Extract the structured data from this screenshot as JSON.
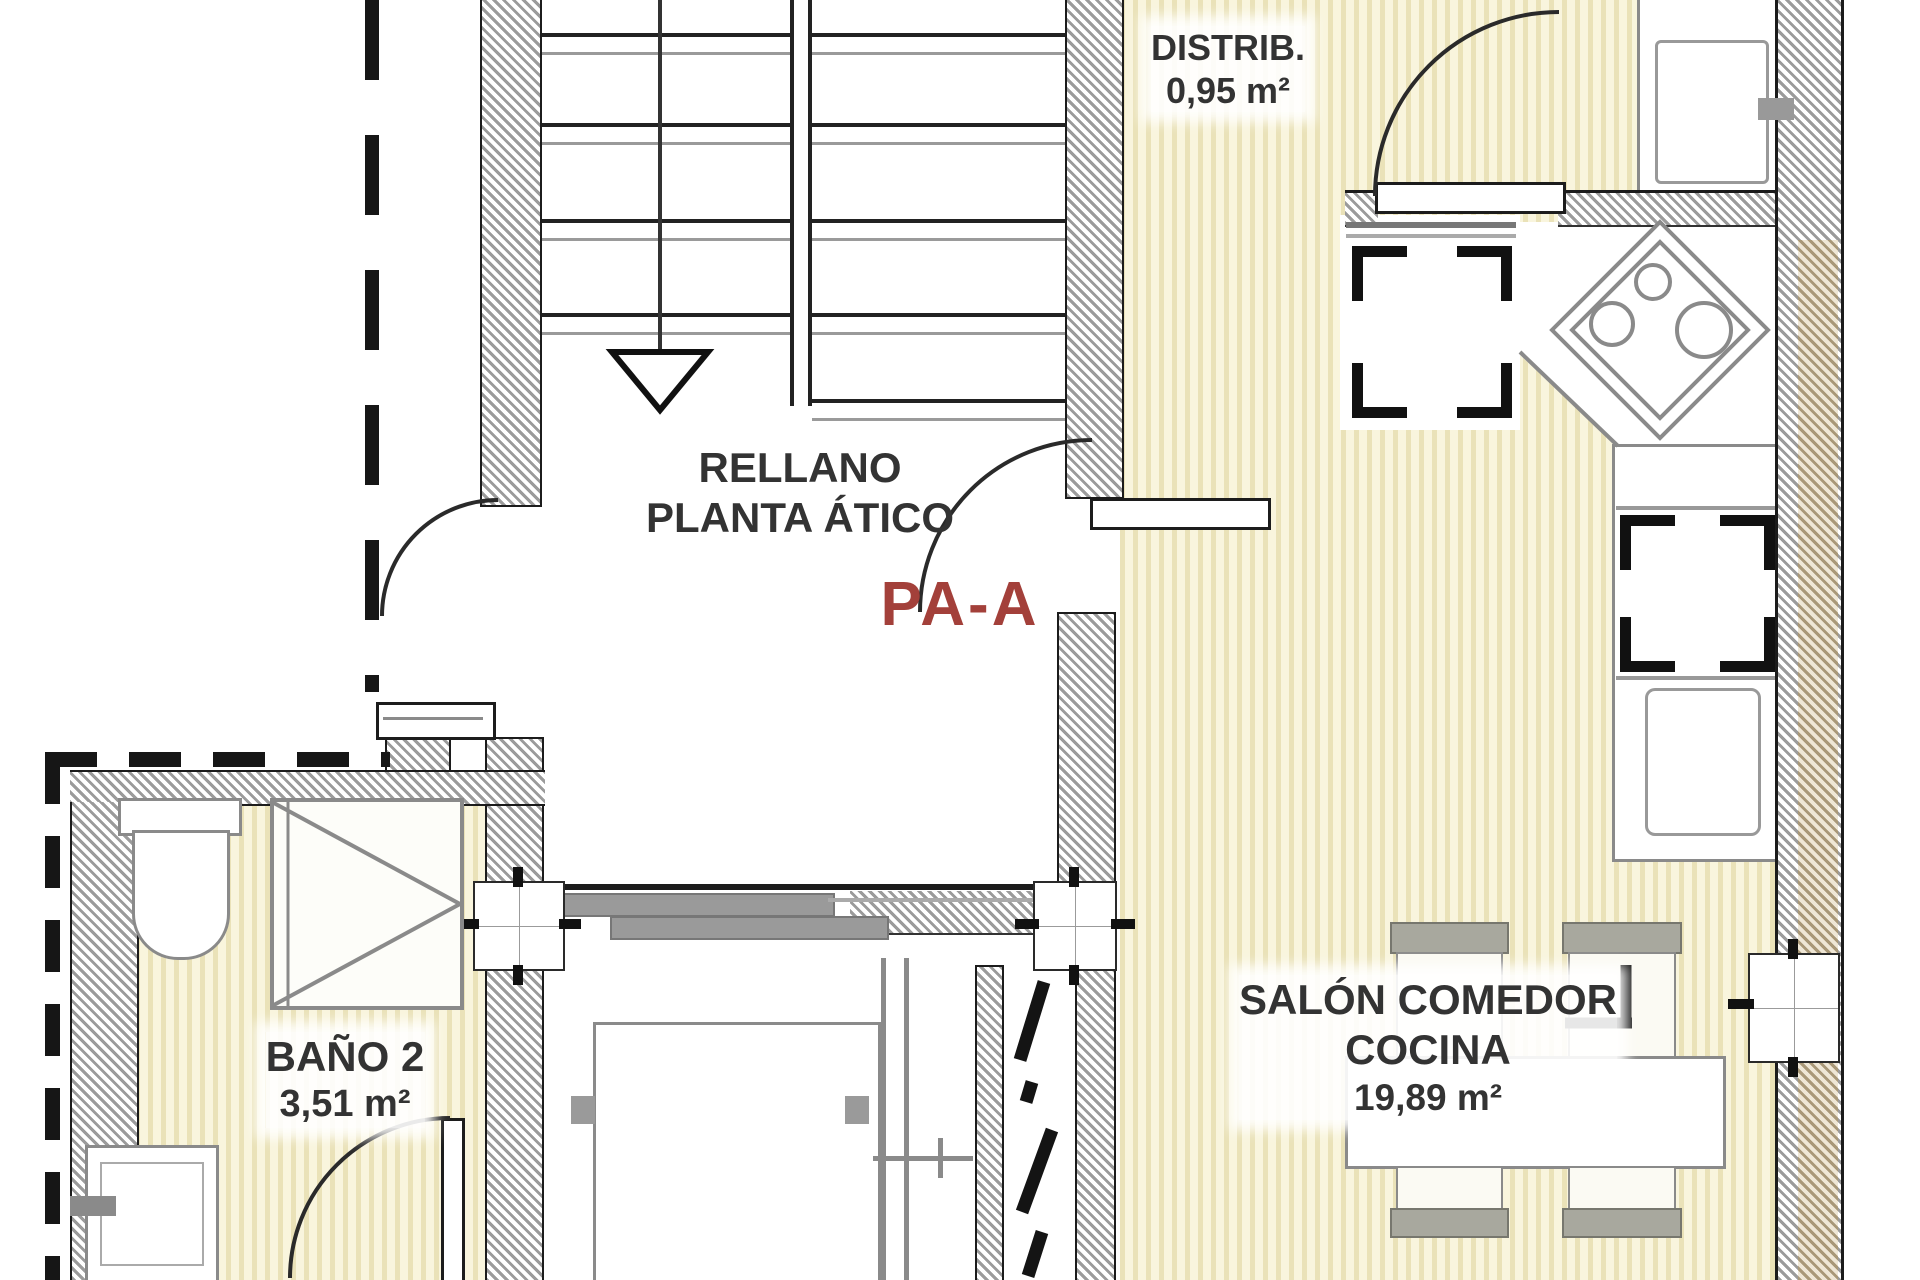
{
  "unit": {
    "code": "PA-A",
    "color": "#a3403a"
  },
  "rooms": {
    "distrib": {
      "label": "DISTRIB.",
      "area": "0,95 m²"
    },
    "rellano": {
      "line1": "RELLANO",
      "line2": "PLANTA ÁTICO"
    },
    "bano2": {
      "label": "BAÑO 2",
      "area": "3,51 m²"
    },
    "salon": {
      "line1": "SALÓN COMEDOR",
      "line2": "COCINA",
      "area": "19,89 m²"
    }
  },
  "palette": {
    "floor_base": "#f9f5dd",
    "floor_stripe": "#eae2b8",
    "wall_hatch_gray": "#9b9b9b",
    "wall_hatch_tan": "#a99878",
    "line_black": "#1c1c1c",
    "line_gray": "#8a8a8a",
    "text": "#333333",
    "unit_red": "#a3403a"
  }
}
